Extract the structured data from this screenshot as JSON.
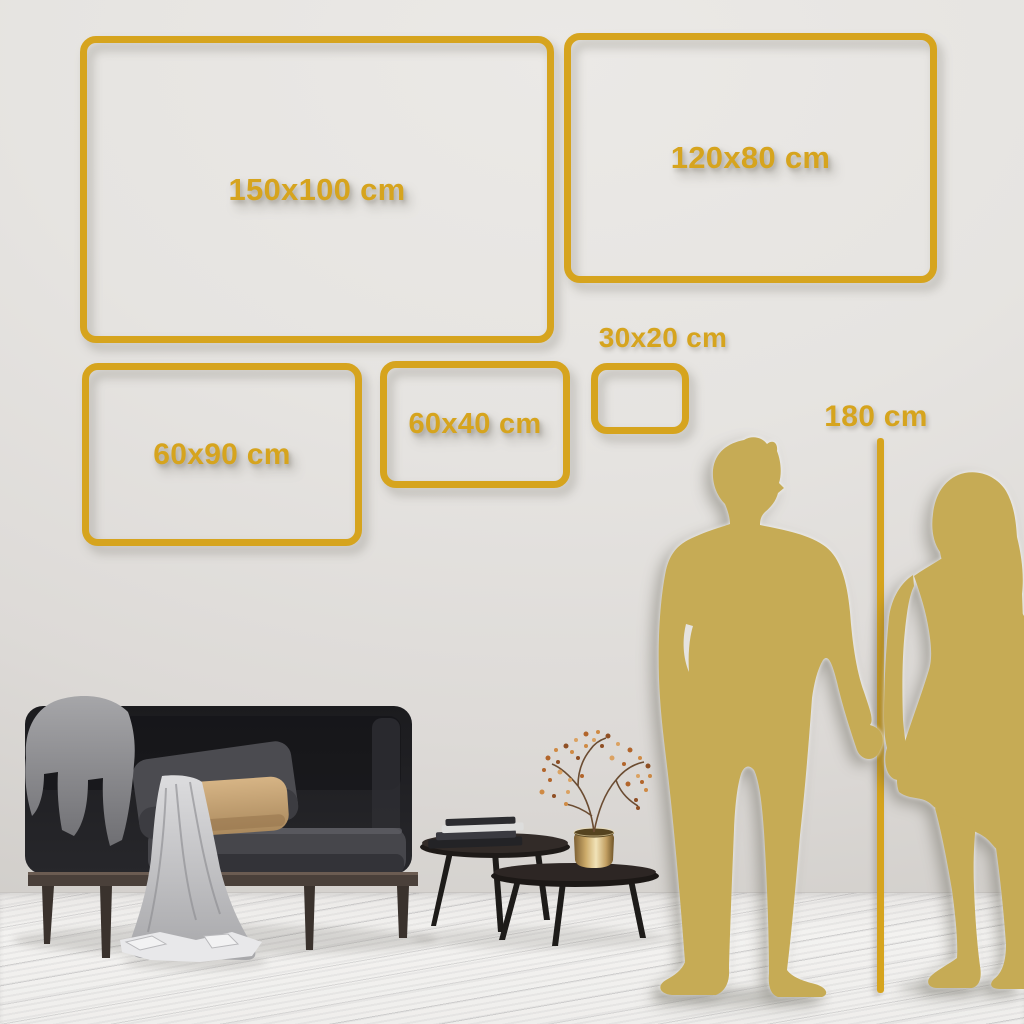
{
  "colors": {
    "frame_gold": "#D6A41E",
    "silhouette_gold": "#C6AB55",
    "wall_light": "#EBE9E6",
    "wall_dark": "#CFCCC8",
    "floor": "#F3F2F0"
  },
  "size_guide": {
    "frames": [
      {
        "label": "150x100 cm"
      },
      {
        "label": "120x80 cm"
      },
      {
        "label": "60x90 cm"
      },
      {
        "label": "60x40 cm"
      },
      {
        "label": "30x20 cm"
      }
    ],
    "height_marker": {
      "label": "180 cm"
    }
  },
  "scene": {
    "objects": [
      "sofa",
      "throw-blanket",
      "draped-cloth",
      "dark-cushion",
      "tan-cushion",
      "nesting-coffee-tables",
      "books",
      "brass-vase",
      "dried-flower-branch",
      "man-silhouette",
      "woman-silhouette",
      "height-reference-line"
    ]
  }
}
